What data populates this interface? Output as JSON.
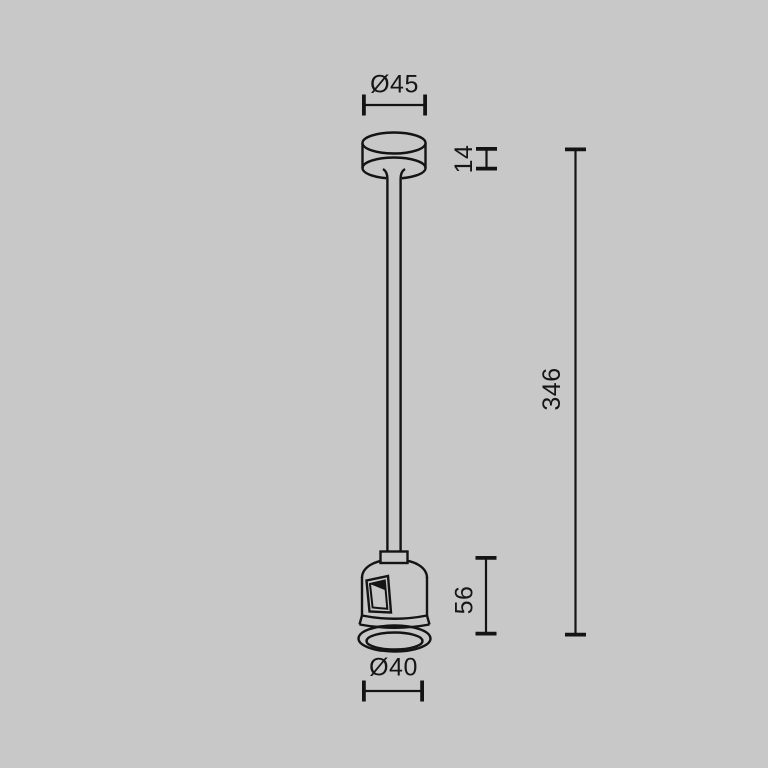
{
  "drawing": {
    "kind": "technical-dimension-drawing",
    "subject": "ceiling-suspension-rod-with-track-connector",
    "background_color": "#c8c8c8",
    "line_color": "#141414",
    "text_color": "#161616"
  },
  "dimensions": {
    "top_diameter": "Ø45",
    "canopy_height": "14",
    "overall_length": "346",
    "connector_height": "56",
    "connector_diameter": "Ø40"
  }
}
